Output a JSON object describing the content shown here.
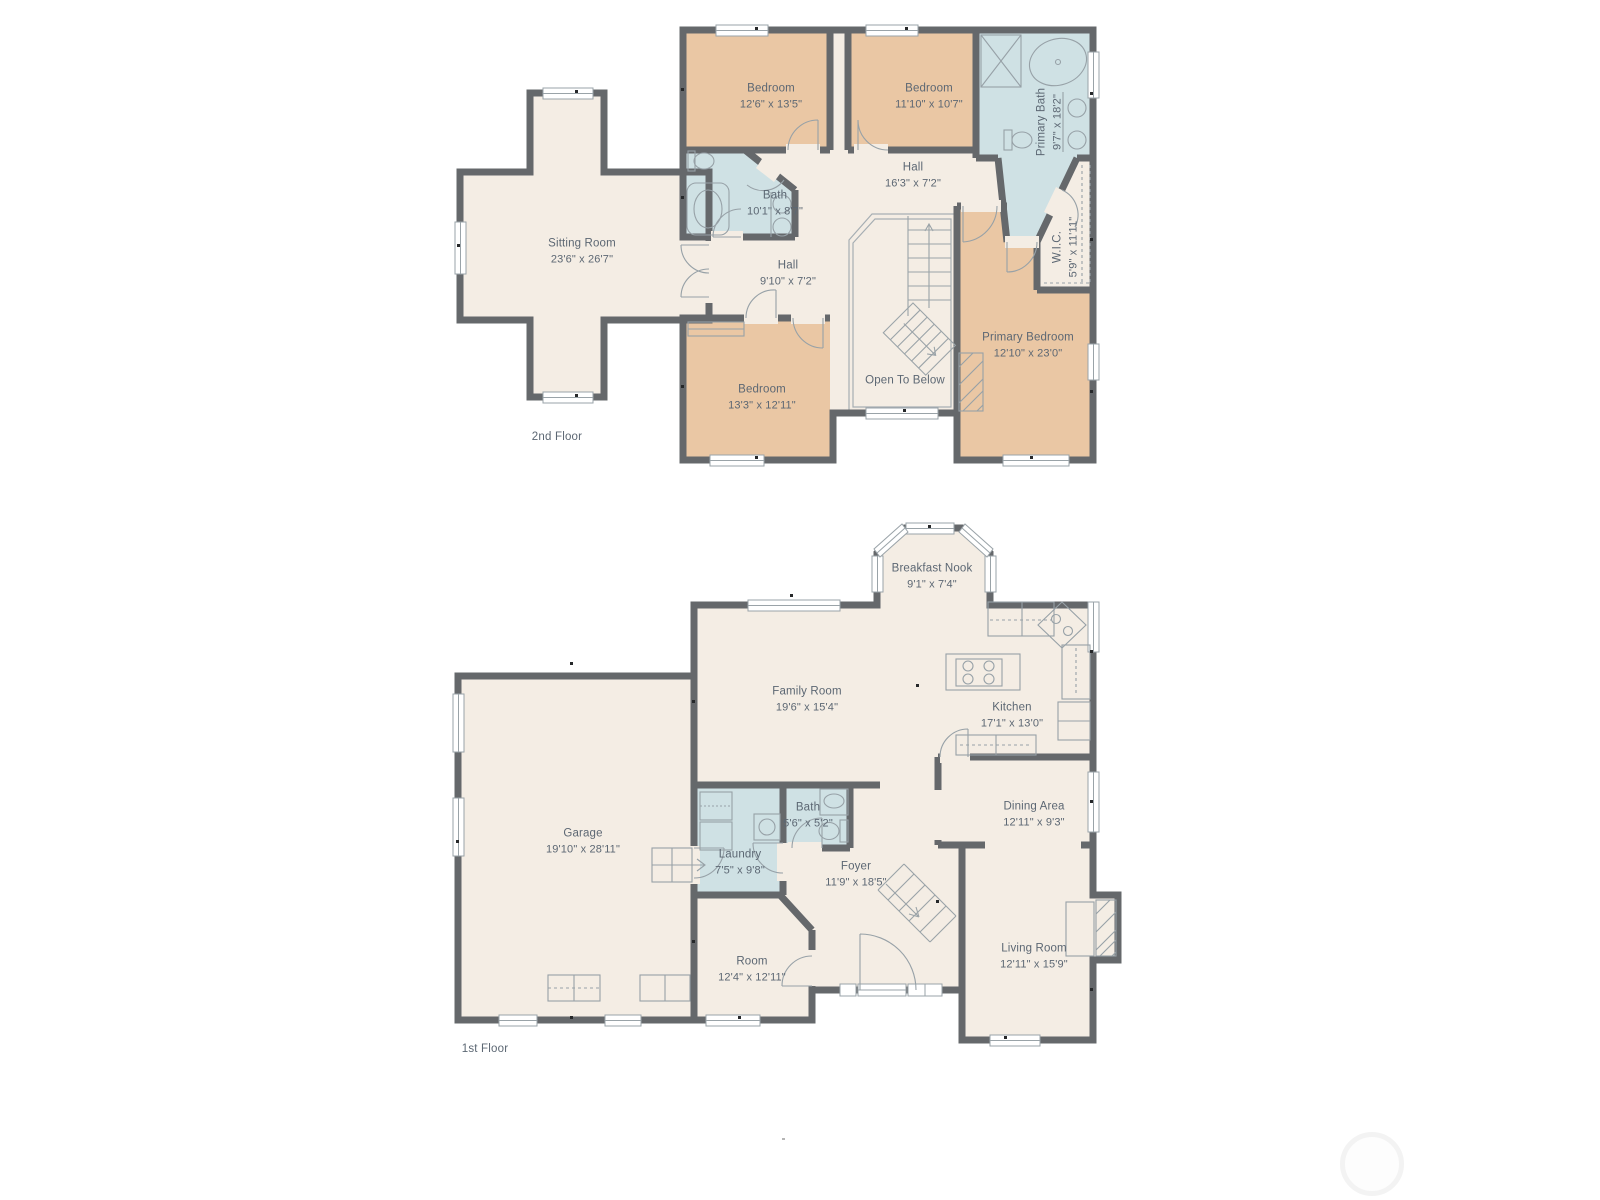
{
  "palette": {
    "background": "#ffffff",
    "wall": "#65686b",
    "floor": "#f4ede4",
    "bedroom_fill": "#eac7a4",
    "bathroom_fill": "#cfe1e4",
    "fixture_line": "#9aa3a8",
    "text": "#5c6773"
  },
  "floors": {
    "second": {
      "label": "2nd Floor",
      "rooms": {
        "bedroom_tl": {
          "name": "Bedroom",
          "dims": "12'6\" x 13'5\""
        },
        "bedroom_tm": {
          "name": "Bedroom",
          "dims": "11'10\" x 10'7\""
        },
        "primary_bath": {
          "name": "Primary Bath",
          "dims": "9'7\" x 18'2\""
        },
        "bath": {
          "name": "Bath",
          "dims": "10'1\" x 8'7\""
        },
        "hall_upper": {
          "name": "Hall",
          "dims": "16'3\" x 7'2\""
        },
        "sitting_room": {
          "name": "Sitting Room",
          "dims": "23'6\" x 26'7\""
        },
        "hall_lower": {
          "name": "Hall",
          "dims": "9'10\" x 7'2\""
        },
        "wic": {
          "name": "W.I.C.",
          "dims": "5'9\" x 11'11\""
        },
        "primary_bedroom": {
          "name": "Primary Bedroom",
          "dims": "12'10\" x 23'0\""
        },
        "bedroom_b": {
          "name": "Bedroom",
          "dims": "13'3\" x 12'11\""
        },
        "open_to_below": {
          "name": "Open To Below"
        }
      }
    },
    "first": {
      "label": "1st Floor",
      "rooms": {
        "breakfast_nook": {
          "name": "Breakfast Nook",
          "dims": "9'1\" x 7'4\""
        },
        "family_room": {
          "name": "Family Room",
          "dims": "19'6\" x 15'4\""
        },
        "kitchen": {
          "name": "Kitchen",
          "dims": "17'1\" x 13'0\""
        },
        "garage": {
          "name": "Garage",
          "dims": "19'10\" x 28'11\""
        },
        "dining_area": {
          "name": "Dining Area",
          "dims": "12'11\" x 9'3\""
        },
        "bath": {
          "name": "Bath",
          "dims": "5'6\" x 5'2\""
        },
        "laundry": {
          "name": "Laundry",
          "dims": "7'5\" x 9'8\""
        },
        "foyer": {
          "name": "Foyer",
          "dims": "11'9\" x 18'5\""
        },
        "room": {
          "name": "Room",
          "dims": "12'4\" x 12'11\""
        },
        "living_room": {
          "name": "Living Room",
          "dims": "12'11\" x 15'9\""
        }
      }
    }
  }
}
